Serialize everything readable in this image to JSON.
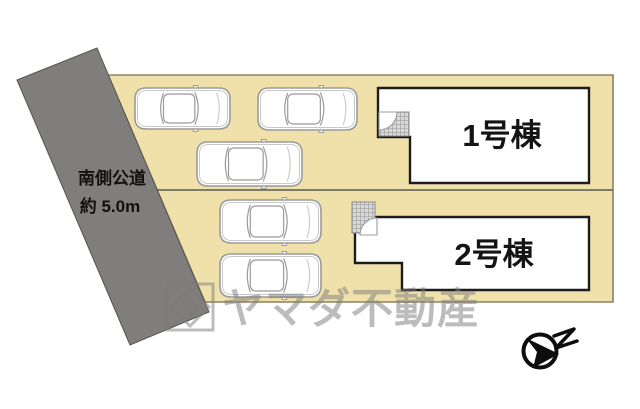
{
  "canvas": {
    "w": 640,
    "h": 409,
    "bg": "#ffffff"
  },
  "road": {
    "points": "17,80 97,48 209,312 130,345",
    "fill": "#7f7e7c",
    "stroke": "#56544e",
    "label_line1": "南側公道",
    "label_line2": "約 5.0m",
    "label_color": "#111111"
  },
  "site": {
    "lot_points": "108,75 613,75 613,302 205,302",
    "lot_fill": "#f0e1ab",
    "lot_border": "#8b8160",
    "divider_points": "157,190 613,190",
    "divider_color": "#6e6c5c"
  },
  "building_style": {
    "fill": "#ffffff",
    "stroke": "#1c1c1c",
    "label_color": "#141414",
    "label_size": 31
  },
  "porch_style": {
    "fill": "#d9d9d9",
    "grid_line": "#a9a9a9",
    "border": "#8c8c8c"
  },
  "buildings": [
    {
      "id": "building-1",
      "label": "1号棟",
      "outline": "M378,88 H589 V183 H410 V137 H378 Z",
      "label_x": 502,
      "label_y": 146,
      "porch": {
        "x": 379,
        "y": 112,
        "w": 30,
        "h": 24
      },
      "door_arc": "M379,112 L397,112 A18,18 0 0 1 379,130 Z"
    },
    {
      "id": "building-2",
      "label": "2号棟",
      "outline": "M366,217 H589 V290 H402 V263 H355 V228 A11,11 0 0 1 366,217 Z",
      "label_x": 494,
      "label_y": 265,
      "porch": {
        "x": 352,
        "y": 202,
        "w": 23,
        "h": 31
      },
      "door_arc": "M377,235 L377,218 A17,17 0 0 0 360,235 Z"
    }
  ],
  "car_style": {
    "stroke": "#9b9b9b",
    "inner": "#c9c9c9",
    "fill": "#ffffff"
  },
  "cars": [
    {
      "x": 135,
      "y": 88,
      "w": 95,
      "h": 41
    },
    {
      "x": 258,
      "y": 88,
      "w": 99,
      "h": 42
    },
    {
      "x": 197,
      "y": 142,
      "w": 105,
      "h": 44
    },
    {
      "x": 220,
      "y": 200,
      "w": 101,
      "h": 43
    },
    {
      "x": 220,
      "y": 254,
      "w": 101,
      "h": 43
    }
  ],
  "watermark": {
    "text": "ヤマダ不動産",
    "color": "#7c7c7c",
    "opacity": 0.5,
    "text_x": 222,
    "text_y": 323,
    "font_size": 42,
    "logo": {
      "x": 167,
      "y": 284,
      "size": 46
    }
  },
  "compass": {
    "cx": 540,
    "cy": 351,
    "r": 16.5,
    "color": "#0d0d0d",
    "needle_points": "559,354 526,338 537,352 533,368",
    "letter": "N",
    "letter_path": "M554,336 L574,329 L556,348 L577,341"
  }
}
